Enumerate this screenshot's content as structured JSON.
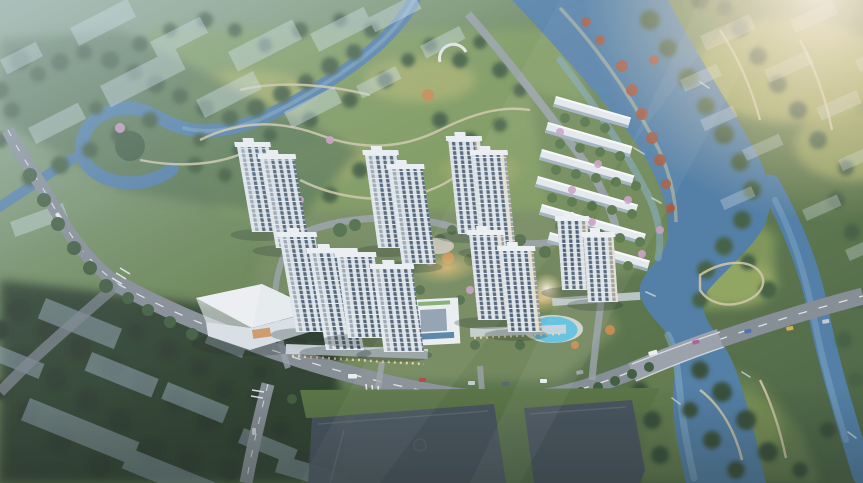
{
  "scene": {
    "kind": "aerial-architectural-rendering",
    "subject": "riverside residential development with high-rise towers, rowhouses, park and sports courts",
    "counts": {
      "tower_slabs": 14,
      "rowhouse_blocks": 6,
      "sports_courts": 2
    }
  },
  "colors": {
    "terrain_top": "#8aa489",
    "terrain_mid": "#68834f",
    "terrain_low": "#47603e",
    "park": "#7e9a58",
    "meadow": "#a9b162",
    "forest": "#3c5838",
    "forest_dark": "#283a28",
    "canopy": "#4e6a42",
    "river": "#4e7ca5",
    "river_light": "#82abca",
    "road": "#848b93",
    "road_line": "#f2f4f6",
    "tower_face": "#dfe5ea",
    "tower_glass": "#4a5d72",
    "roof": "#f3f5f7",
    "ghost": "#d7e4ee",
    "ghost_dark": "#97a9ba",
    "court": "#424d5a",
    "pool": "#56c0e0",
    "blossom": "#cf9fc4",
    "autumn": "#a3573c",
    "amber": "#e2b96d",
    "sun": "#fff3e2",
    "haze": "#c6d8e4",
    "path": "#d6cbaa"
  }
}
